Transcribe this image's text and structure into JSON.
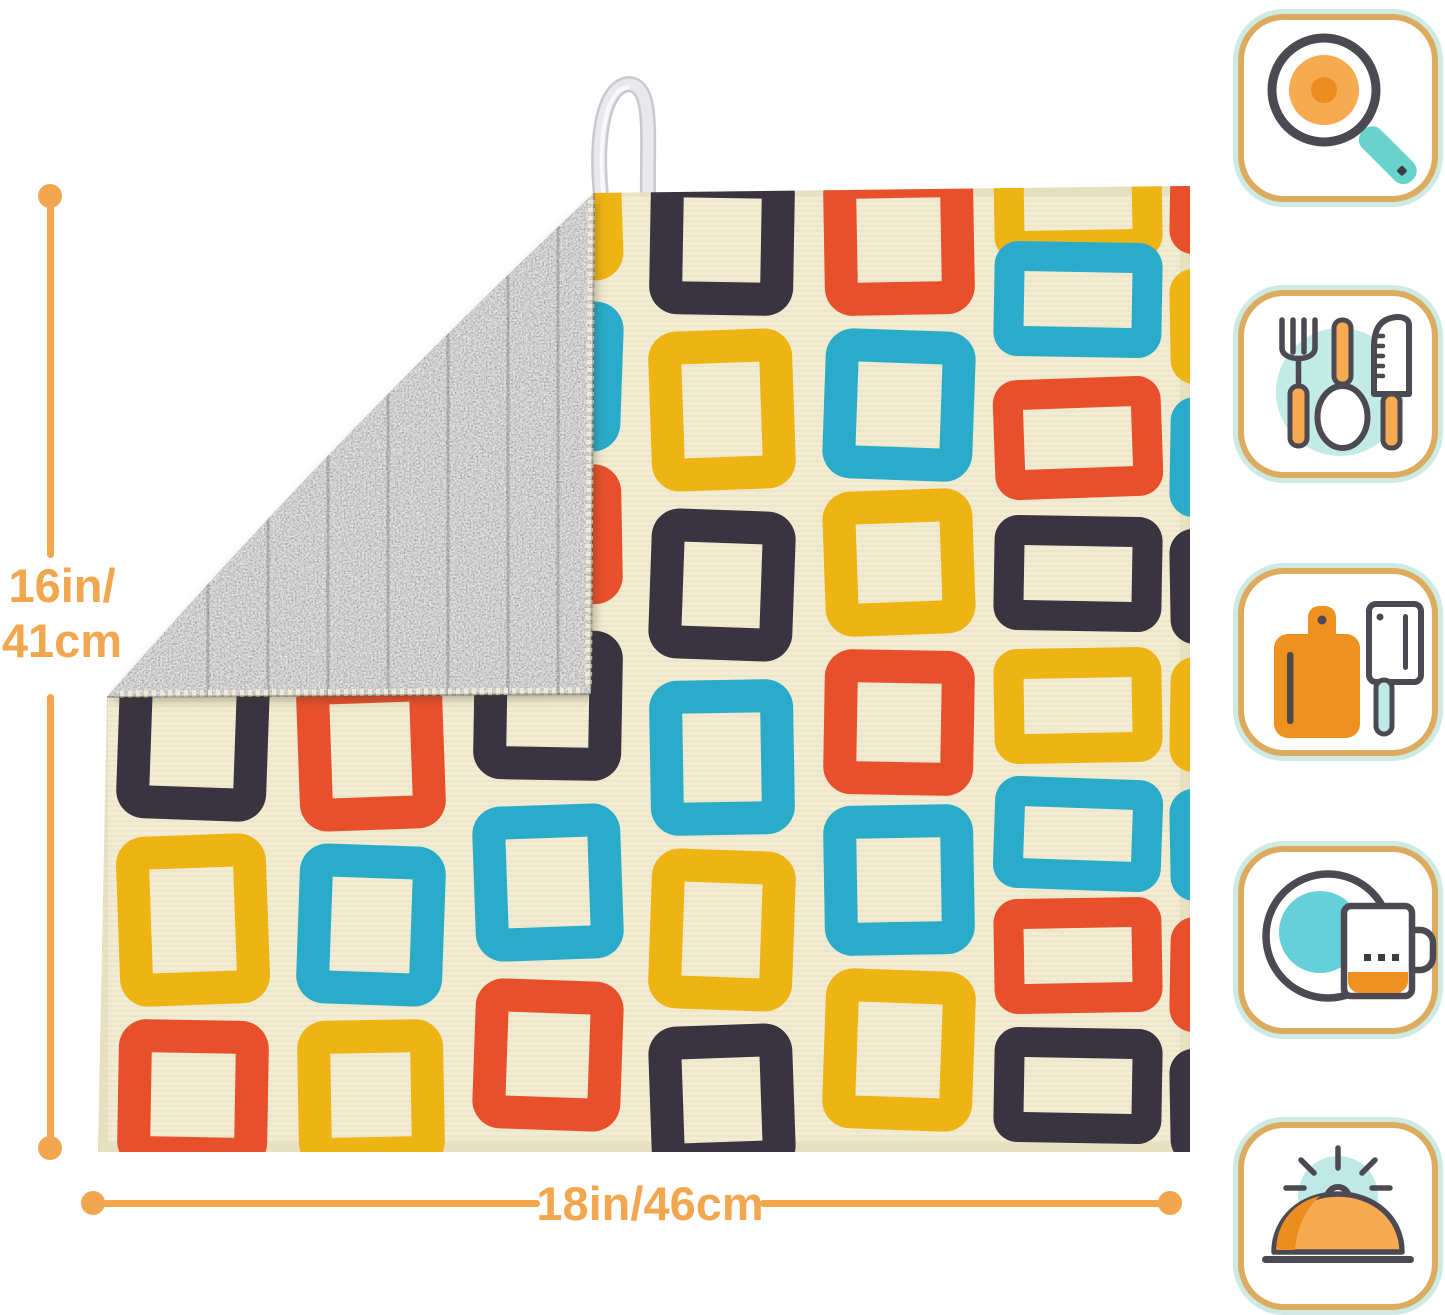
{
  "product_image": {
    "page_background": "#ffffff",
    "mat": {
      "type": "dish-drying-mat",
      "front_color": "#f2edd2",
      "back_color": "#908e8a",
      "edge_color": "#e7dfbf",
      "loop_color": "#e4e4e8",
      "pattern_colors": {
        "teal": "#2aabca",
        "yellow": "#eeb414",
        "red": "#e8502b",
        "dark": "#3a3440"
      },
      "pattern_columns": [
        {
          "x": 16,
          "w": 150,
          "t": 33,
          "cells": [
            {
              "y": -40,
              "h": 150,
              "c": "yellow",
              "r": -2
            },
            {
              "y": 125,
              "h": 150,
              "c": "teal",
              "r": 2
            },
            {
              "y": 290,
              "h": 150,
              "c": "red",
              "r": -1
            },
            {
              "y": 470,
              "h": 160,
              "c": "dark",
              "r": 2
            },
            {
              "y": 645,
              "h": 170,
              "c": "yellow",
              "r": -2
            },
            {
              "y": 830,
              "h": 150,
              "c": "red",
              "r": 1
            }
          ]
        },
        {
          "x": 196,
          "w": 146,
          "t": 33,
          "cells": [
            {
              "y": -30,
              "h": 150,
              "c": "dark",
              "r": 1
            },
            {
              "y": 135,
              "h": 150,
              "c": "teal",
              "r": -2
            },
            {
              "y": 300,
              "h": 150,
              "c": "yellow",
              "r": 2
            },
            {
              "y": 480,
              "h": 160,
              "c": "red",
              "r": -2
            },
            {
              "y": 655,
              "h": 160,
              "c": "teal",
              "r": 2
            },
            {
              "y": 830,
              "h": 150,
              "c": "yellow",
              "r": -1
            }
          ]
        },
        {
          "x": 372,
          "w": 148,
          "t": 33,
          "cells": [
            {
              "y": -48,
              "h": 140,
              "c": "yellow",
              "r": -2
            },
            {
              "y": 110,
              "h": 150,
              "c": "teal",
              "r": 2
            },
            {
              "y": 275,
              "h": 140,
              "c": "red",
              "r": -1
            },
            {
              "y": 440,
              "h": 150,
              "c": "dark",
              "r": 1
            },
            {
              "y": 615,
              "h": 155,
              "c": "teal",
              "r": -2
            },
            {
              "y": 790,
              "h": 150,
              "c": "red",
              "r": 2
            }
          ]
        },
        {
          "x": 548,
          "w": 144,
          "t": 33,
          "cells": [
            {
              "y": -25,
              "h": 150,
              "c": "dark",
              "r": 1
            },
            {
              "y": 140,
              "h": 160,
              "c": "yellow",
              "r": -2
            },
            {
              "y": 320,
              "h": 150,
              "c": "dark",
              "r": 2
            },
            {
              "y": 490,
              "h": 155,
              "c": "teal",
              "r": -1
            },
            {
              "y": 660,
              "h": 160,
              "c": "yellow",
              "r": 2
            },
            {
              "y": 835,
              "h": 150,
              "c": "dark",
              "r": -2
            }
          ]
        },
        {
          "x": 722,
          "w": 150,
          "t": 33,
          "cells": [
            {
              "y": -25,
              "h": 150,
              "c": "red",
              "r": -1
            },
            {
              "y": 140,
              "h": 150,
              "c": "teal",
              "r": 2
            },
            {
              "y": 300,
              "h": 145,
              "c": "yellow",
              "r": -2
            },
            {
              "y": 460,
              "h": 145,
              "c": "red",
              "r": 1
            },
            {
              "y": 615,
              "h": 150,
              "c": "teal",
              "r": -1
            },
            {
              "y": 780,
              "h": 160,
              "c": "yellow",
              "r": 2
            }
          ]
        },
        {
          "x": 892,
          "w": 168,
          "t": 30,
          "cells": [
            {
              "y": -45,
              "h": 115,
              "c": "yellow",
              "r": -1
            },
            {
              "y": 52,
              "h": 115,
              "c": "teal",
              "r": 1
            },
            {
              "y": 188,
              "h": 120,
              "c": "red",
              "r": -2
            },
            {
              "y": 326,
              "h": 115,
              "c": "dark",
              "r": 1
            },
            {
              "y": 458,
              "h": 115,
              "c": "yellow",
              "r": -1
            },
            {
              "y": 588,
              "h": 112,
              "c": "teal",
              "r": 2
            },
            {
              "y": 708,
              "h": 115,
              "c": "red",
              "r": -1
            },
            {
              "y": 838,
              "h": 115,
              "c": "dark",
              "r": 1
            }
          ]
        },
        {
          "x": 1068,
          "w": 150,
          "t": 30,
          "cells": [
            {
              "y": -50,
              "h": 115,
              "c": "red",
              "r": 1
            },
            {
              "y": 78,
              "h": 115,
              "c": "yellow",
              "r": -1
            },
            {
              "y": 208,
              "h": 120,
              "c": "teal",
              "r": 1
            },
            {
              "y": 338,
              "h": 115,
              "c": "dark",
              "r": -1
            },
            {
              "y": 468,
              "h": 115,
              "c": "yellow",
              "r": 1
            },
            {
              "y": 598,
              "h": 112,
              "c": "teal",
              "r": -1
            },
            {
              "y": 728,
              "h": 115,
              "c": "red",
              "r": 1
            },
            {
              "y": 858,
              "h": 115,
              "c": "dark",
              "r": -1
            }
          ]
        }
      ]
    },
    "dimensions": {
      "accent_color": "#f2a64d",
      "height_label_line1": "16in/",
      "height_label_line2": "41cm",
      "width_label": "18in/46cm"
    },
    "icon_rail": {
      "border_color": "#dcab5e",
      "ring_color": "#cdeae5",
      "icons": [
        {
          "name": "frying-pan-search-icon"
        },
        {
          "name": "cutlery-icon"
        },
        {
          "name": "cutting-board-cleaver-icon"
        },
        {
          "name": "plate-mug-icon"
        },
        {
          "name": "serving-cloche-icon"
        }
      ]
    }
  }
}
